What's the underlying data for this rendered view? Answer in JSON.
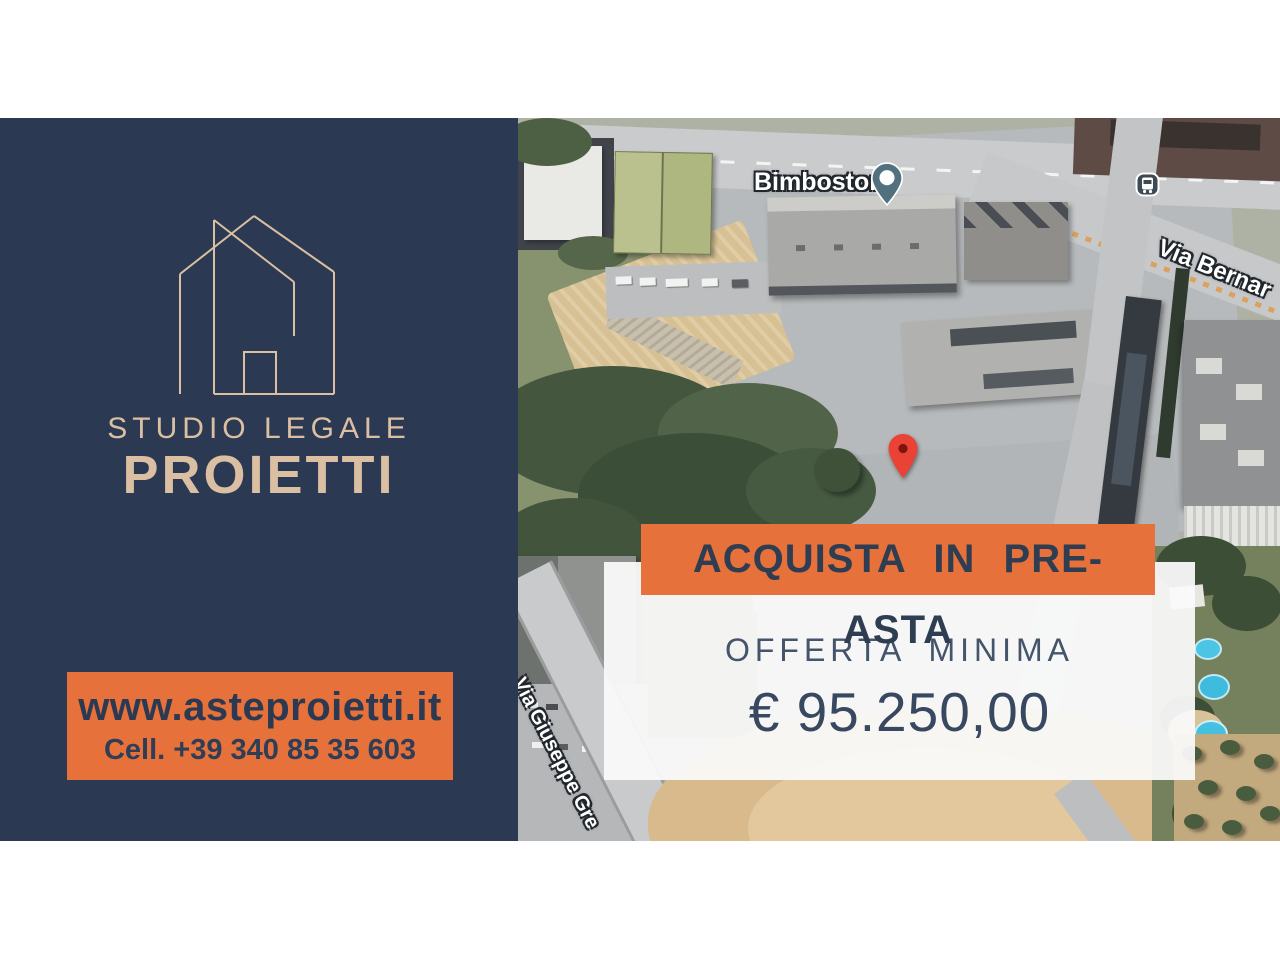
{
  "brand": {
    "name_line1": "STUDIO LEGALE",
    "name_line2": "PROIETTI",
    "website": "www.asteproietti.it",
    "phone": "Cell. +39 340 85 35 603"
  },
  "offer": {
    "banner": "ACQUISTA IN PRE-ASTA",
    "label": "OFFERTA MINIMA",
    "amount": "€ 95.250,00"
  },
  "map": {
    "poi_label": "Bimbostore",
    "street_label_top": "Via Bernar",
    "street_label_left": "Via Giuseppe Gre",
    "icons": {
      "poi_pin": "map-pin-icon",
      "transit_stop": "bus-station-icon",
      "property_marker": "red-map-pin-icon"
    }
  },
  "colors": {
    "panel_navy": "#2B3A52",
    "logo_beige": "#DBBFA3",
    "accent_orange": "#E7713A",
    "text_navy": "#2E3D52",
    "card_white": "#FAFAFA",
    "pin_red": "#EA4335",
    "pin_slate": "#53707E"
  }
}
